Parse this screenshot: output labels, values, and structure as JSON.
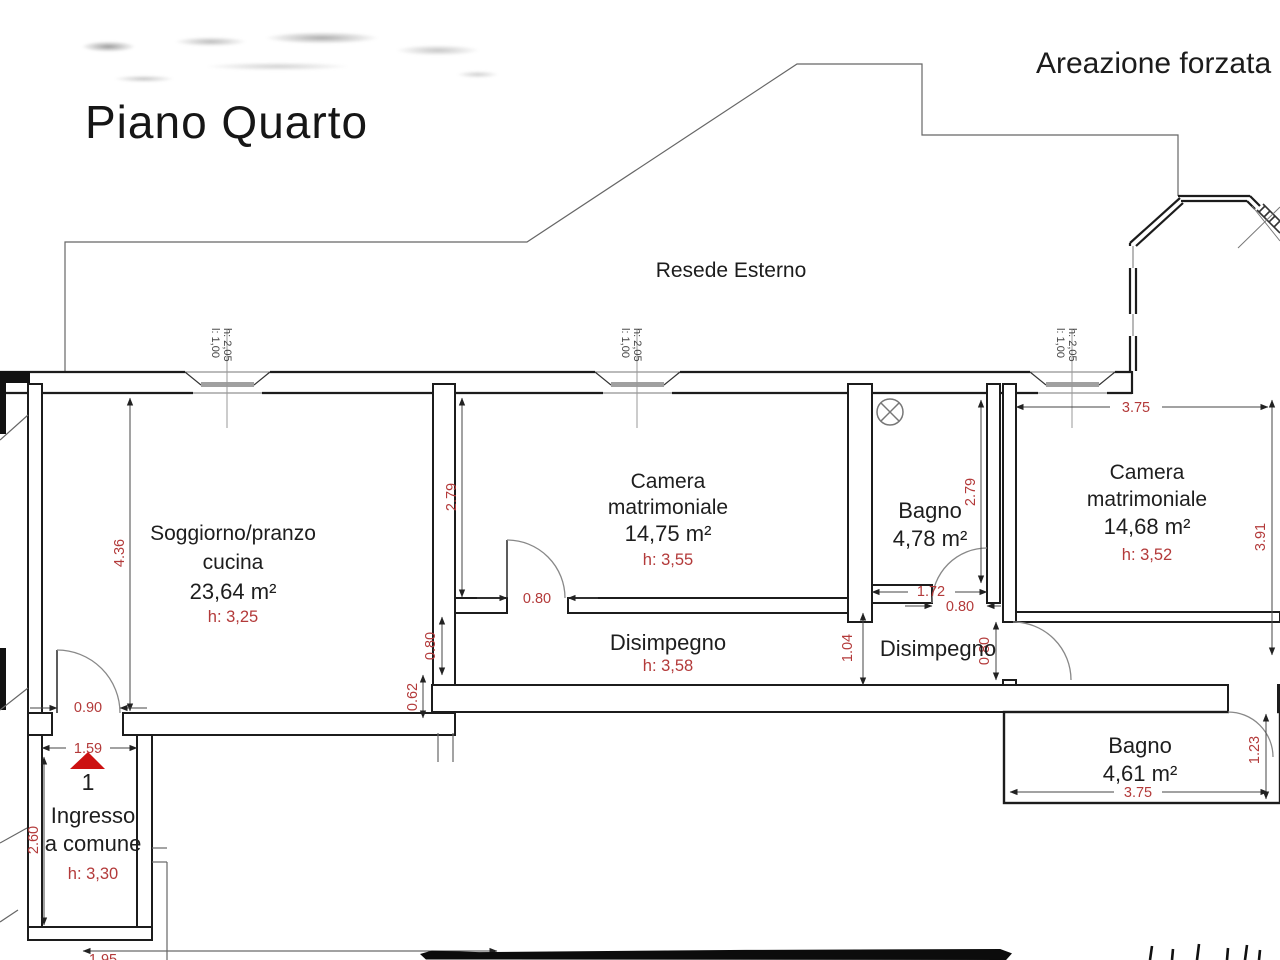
{
  "title": "Piano Quarto",
  "notes": {
    "top_right": "Areazione forzata",
    "outdoor": "Resede Esterno"
  },
  "window_tag": {
    "height": "h: 2,05",
    "width": "l: 1,00"
  },
  "rooms": {
    "soggiorno": {
      "name1": "Soggiorno/pranzo",
      "name2": "cucina",
      "area": "23,64 m²",
      "height": "h: 3,25"
    },
    "camera_centro": {
      "name1": "Camera",
      "name2": "matrimoniale",
      "area": "14,75 m²",
      "height": "h: 3,55"
    },
    "bagno_centro": {
      "name": "Bagno",
      "area": "4,78 m²"
    },
    "camera_destra": {
      "name1": "Camera",
      "name2": "matrimoniale",
      "area": "14,68 m²",
      "height": "h: 3,52"
    },
    "disimpegno_centro": {
      "name": "Disimpegno",
      "height": "h: 3,58"
    },
    "disimpegno_destra": {
      "name": "Disimpegno"
    },
    "bagno_destra": {
      "name": "Bagno",
      "area": "4,61 m²"
    },
    "ingresso": {
      "name1": "Ingresso",
      "name2": "a comune",
      "height": "h: 3,30",
      "unit": "1"
    }
  },
  "dims": {
    "sogg_h": "4.36",
    "sogg_door": "0.90",
    "ingr_w": "1.59",
    "ingr_h": "2.60",
    "corr_w": "0.80",
    "step": "0.62",
    "cam1_d": "2.79",
    "cam1_door": "0.80",
    "bagno1_d": "2.79",
    "bagno1_w": "1.72",
    "bagno1_door": "0.80",
    "dis2_w": "1.04",
    "dis2_door": "0.80",
    "cam2_w": "3.75",
    "cam2_d": "3.91",
    "bagno2_w": "3.75",
    "bagno2_d": "1.23",
    "bottom_partial": "1.95"
  },
  "colors": {
    "wall": "#1c1c1c",
    "dim_text": "#b33a3a",
    "thin_line": "#666666",
    "arrow_red": "#cc1111",
    "sill": "#a0a0a0"
  }
}
